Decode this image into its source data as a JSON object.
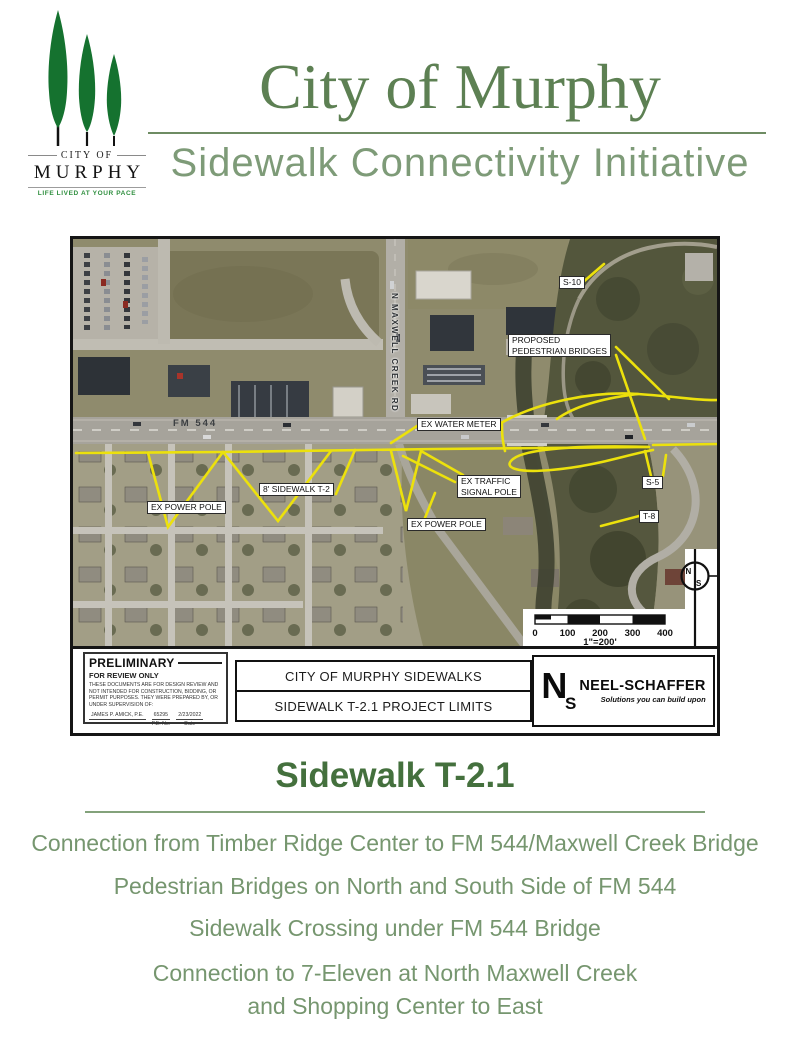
{
  "header": {
    "logo": {
      "city_of": "CITY OF",
      "name": "MURPHY",
      "tagline": "LIFE LIVED AT YOUR PACE"
    },
    "title": "City of Murphy",
    "subtitle": "Sidewalk Connectivity Initiative"
  },
  "map": {
    "labels": {
      "s10": "S-10",
      "proposed_line1": "PROPOSED",
      "proposed_line2": "PEDESTRIAN BRIDGES",
      "maxwell_rd": "N MAXWELL CREEK RD",
      "fm544": "FM 544",
      "water_meter": "EX WATER METER",
      "power_pole_left": "EX POWER POLE",
      "sidewalk_t2": "8' SIDEWALK T-2",
      "traffic_signal_line1": "EX TRAFFIC",
      "traffic_signal_line2": "SIGNAL POLE",
      "power_pole_right": "EX POWER POLE",
      "s5": "S-5",
      "t8": "T-8"
    },
    "scale": {
      "ticks": [
        "0",
        "100",
        "200",
        "300",
        "400"
      ],
      "ratio": "1\"=200'"
    },
    "north": {
      "n": "N",
      "s": "S"
    },
    "preliminary": {
      "title": "PRELIMINARY",
      "subtitle": "FOR REVIEW ONLY",
      "body": "THESE DOCUMENTS ARE FOR DESIGN REVIEW AND NOT INTENDED FOR CONSTRUCTION, BIDDING, OR PERMIT PURPOSES. THEY WERE PREPARED BY, OR UNDER SUPERVISION OF:",
      "engineer": "JAMES P. AMICK, P.E.",
      "pe_no": "65295",
      "pe_no_label": "P.E. No.",
      "date": "2/23/2022",
      "date_label": "Date"
    },
    "title_block": {
      "line1": "CITY OF MURPHY SIDEWALKS",
      "line2": "SIDEWALK T-2.1 PROJECT LIMITS"
    },
    "firm": {
      "monogram_n": "N",
      "monogram_s": "S",
      "name": "NEEL-SCHAFFER",
      "tagline": "Solutions you can build upon"
    }
  },
  "bottom": {
    "heading": "Sidewalk T-2.1",
    "lines": [
      "Connection from Timber Ridge Center to FM 544/Maxwell Creek Bridge",
      "Pedestrian Bridges on North and South Side of FM 544",
      "Sidewalk Crossing under FM 544 Bridge",
      "Connection to 7-Eleven at North Maxwell Creek",
      "and Shopping Center to East"
    ]
  },
  "colors": {
    "logo_green": "#15722f",
    "title_green": "#5d8053",
    "subtitle_green": "#7e9b78",
    "heading_green": "#44703d",
    "body_green": "#76966f",
    "map_yellow": "#ece10c"
  }
}
